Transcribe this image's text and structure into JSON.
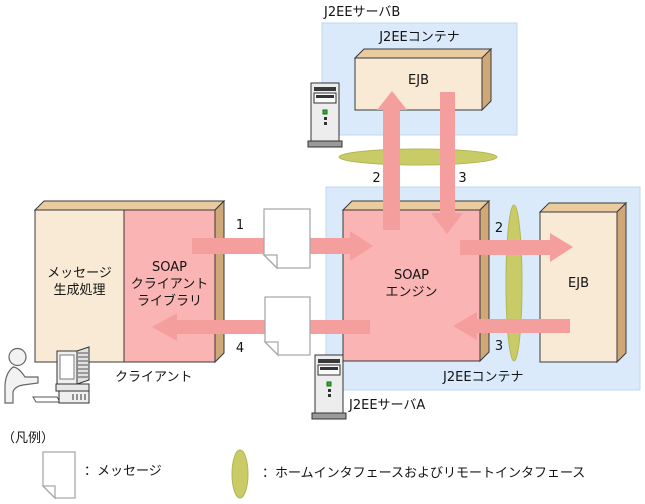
{
  "colors": {
    "container_fill": "#daeafa",
    "container_stroke": "#bdd8ef",
    "box_beige": "#f9ead6",
    "box_pink": "#fab4b4",
    "box_top": "#e9cb9f",
    "box_side": "#d0a878",
    "arrow": "#f59e9e",
    "olive": "#c9cc66",
    "olive_stroke": "#b2b657",
    "doc_border": "#a9a9a9",
    "outline": "#3a3a3a"
  },
  "nodes": {
    "server_b_label": "J2EEサーバB",
    "container_b_label": "J2EEコンテナ",
    "ejb_b_label": "EJB",
    "soap_engine_label": "SOAP\nエンジン",
    "ejb_a_label": "EJB",
    "container_a_label": "J2EEコンテナ",
    "server_a_label": "J2EEサーバA",
    "message_gen_label": "メッセージ\n生成処理",
    "soap_client_lib_label": "SOAP\nクライアント\nライブラリ",
    "client_label": "クライアント"
  },
  "flow_steps": {
    "client_request": "1",
    "b_invoke": "2",
    "b_return": "3",
    "client_response": "4",
    "a_invoke": "2",
    "a_return": "3"
  },
  "legend": {
    "title": "（凡例）",
    "message_label": "：メッセージ",
    "interface_label": "：ホームインタフェースおよびリモートインタフェース"
  },
  "icons": {
    "message": "message-document-icon",
    "interface": "interface-ellipse-icon",
    "server": "server-tower-icon",
    "user": "user-workstation-icon"
  }
}
